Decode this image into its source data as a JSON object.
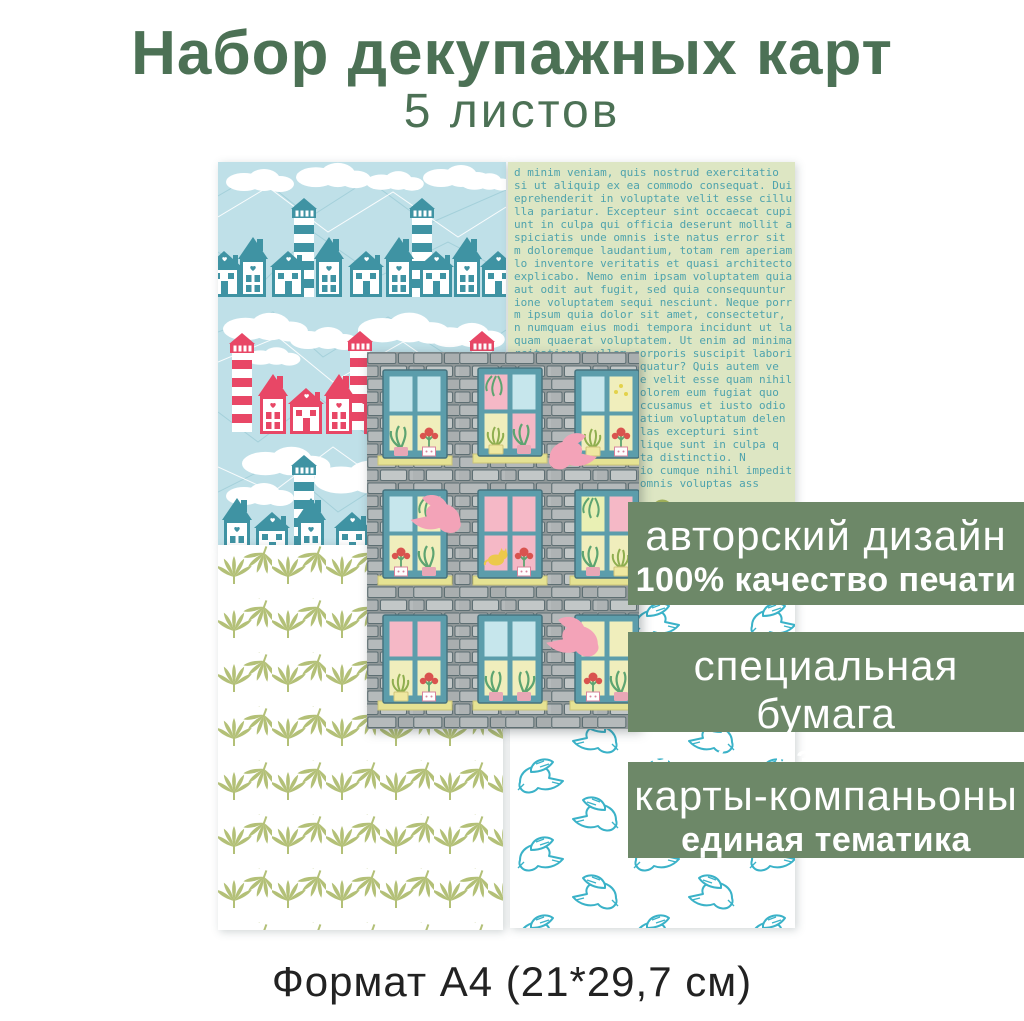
{
  "header": {
    "title": "Набор декупажных карт",
    "subtitle": "5 листов"
  },
  "banners": [
    {
      "line1": "авторский дизайн",
      "line2": "100% качество печати"
    },
    {
      "line1": "специальная бумага",
      "line2": "четкое изображение"
    },
    {
      "line1": "карты-компаньоны",
      "line2": "единая тематика"
    }
  ],
  "text_card": {
    "content": "d minim veniam, quis nostrud exercitatio\nsi ut aliquip ex ea commodo consequat. Duis\neprehenderit in voluptate velit esse cillum\nlla pariatur. Excepteur sint occaecat cupi\nunt in culpa qui officia deserunt mollit anim id e\nspiciatis unde omnis iste natus error sit\nm doloremque laudantium, totam rem aperiam,\nlo inventore veritatis et quasi architecto be\nexplicabo. Nemo enim ipsam voluptatem quia v\naut odit aut fugit, sed quia consequuntur ma\nione voluptatem sequi nesciunt. Neque porro qu\nm ipsum quia dolor sit amet, consectetur, adip\nn numquam eius modi tempora incidunt ut labor\nquam quaerat voluptatem. Ut enim ad minima v\nrcitationem ullam corporis suscipit labori\n                   quatur? Quis autem ve\n                   e velit esse quam nihil\n                   olorem eum fugiat quo\n                   ccusamus et iusto odio\n                   atium voluptatum delen\n                   las excepturi sint\n                   lique sunt in culpa q\n                   ta distinctio. N\n                   io cumque nihil impedit\n                   omnis voluptas ass"
  },
  "footer": {
    "format_label": "Формат А4 (21*29,7 см)"
  },
  "colors": {
    "title_green": "#4c7155",
    "banner_green": "#6d8868",
    "card_blue_bg": "#bfe0e8",
    "teal_house": "#3f93a3",
    "red_house": "#e84766",
    "text_card_bg": "#dde6c3",
    "text_card_ink": "#4fa3ad",
    "leaf_olive": "#b3c077",
    "dove_outline_teal": "#3ab2c8",
    "brick_gray": "#949b9c",
    "window_frame_teal": "#5c9dab",
    "pink_dove": "#f3a3b8",
    "footer_ink": "#222222"
  }
}
